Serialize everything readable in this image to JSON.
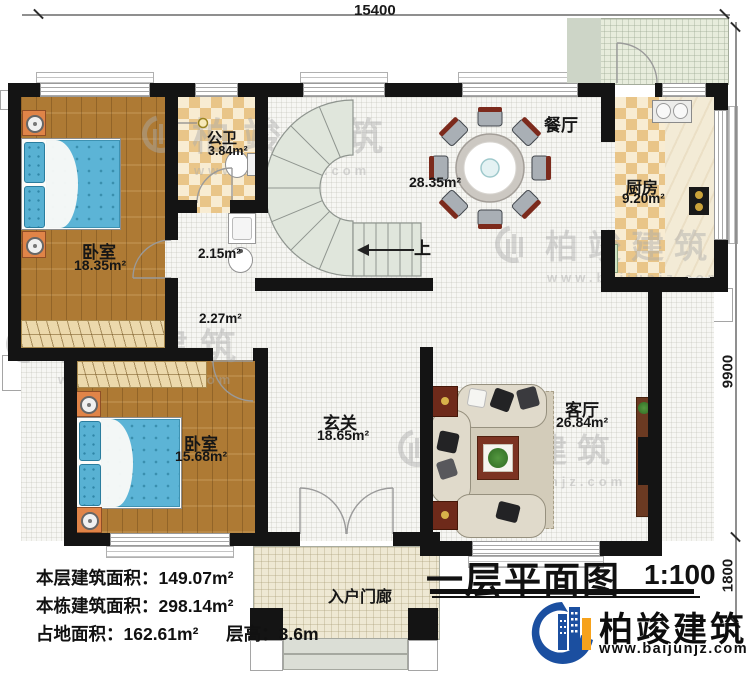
{
  "plan": {
    "title": "一层平面图",
    "scale": "1:100",
    "dims": {
      "width_mm": "15400",
      "depth_main_mm": "9900",
      "depth_porch_mm": "1800"
    },
    "rooms": {
      "bedroom1": {
        "name": "卧室",
        "area": "18.35m²"
      },
      "bedroom2": {
        "name": "卧室",
        "area": "15.68m²"
      },
      "bath": {
        "name": "公卫",
        "area": "3.84m²"
      },
      "vanity_area": {
        "area": "2.15m²"
      },
      "hall_area": {
        "area": "2.27m²"
      },
      "dining": {
        "name": "餐厅",
        "area": "28.35m²"
      },
      "kitchen": {
        "name": "厨房",
        "area": "9.20m²"
      },
      "foyer": {
        "name": "玄关",
        "area": "18.65m²"
      },
      "living": {
        "name": "客厅",
        "area": "26.84m²"
      },
      "porch": {
        "name": "入户门廊"
      }
    },
    "stair_up_label": "上",
    "stats": {
      "floor_area_label": "本层建筑面积：",
      "floor_area": "149.07m²",
      "building_area_label": "本栋建筑面积：",
      "building_area": "298.14m²",
      "footprint_label": "占地面积：",
      "footprint": "162.61m²",
      "height_label": "层高：",
      "height": "3.6m"
    }
  },
  "branding": {
    "company": "柏竣建筑",
    "website": "www.baijunjz.com"
  },
  "watermark": {
    "text": "柏竣建筑",
    "site": "www.baijunjz.com"
  },
  "colors": {
    "wall": "#141414",
    "wood": "#ae7a34",
    "bed": "#5cb4d6",
    "logo_blue": "#1b4fa0",
    "logo_orange": "#f6a21c"
  }
}
